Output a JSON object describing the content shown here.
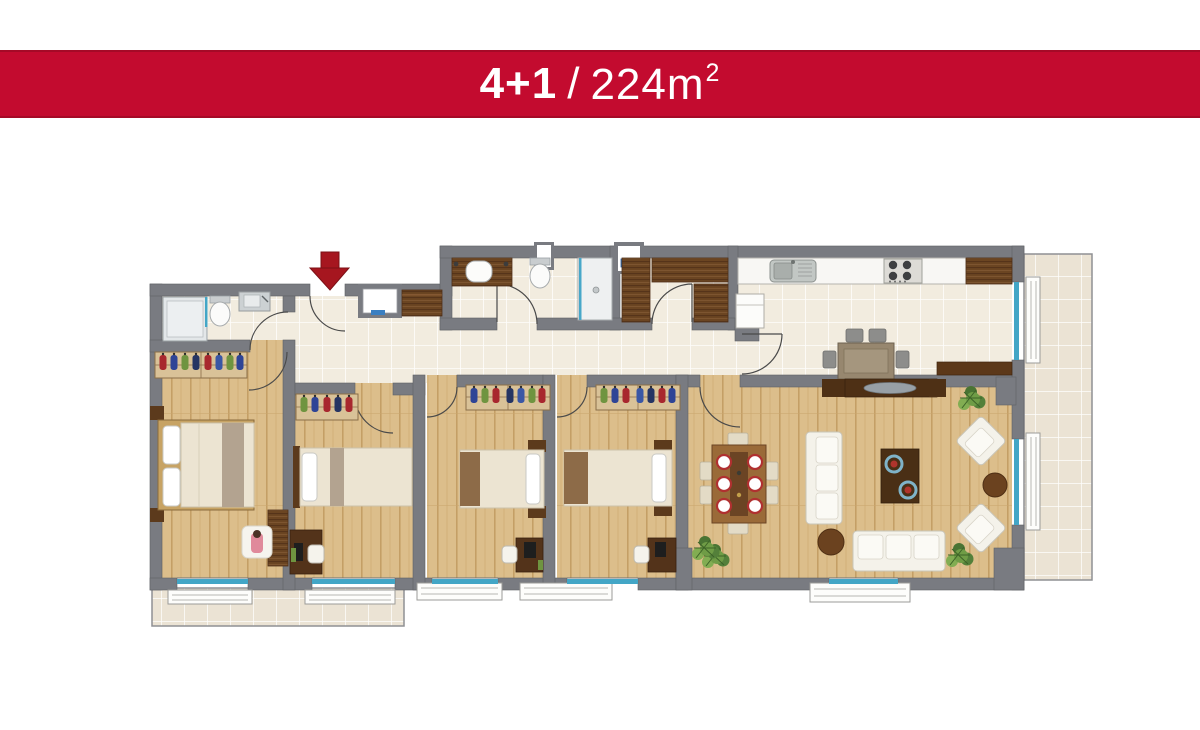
{
  "header": {
    "unit_type": "4+1",
    "separator": "/",
    "area": "224m",
    "area_sup": "2",
    "full_text": "4+1 / 224m2",
    "background": "#c30b2f",
    "text_color": "#ffffff"
  },
  "plan": {
    "entrance_marker": "red-arrow-down",
    "palette": {
      "wall": "#797b81",
      "wood_floor": "#dcbe8b",
      "tile_floor": "#f2ecdf",
      "balcony_tile": "#ebe3d4",
      "dark_wood": "#6b4522",
      "window_glass": "#43a6c6",
      "accent_red": "#a6161f",
      "furniture_white": "#f5f3ec"
    },
    "rooms": [
      "entrance-hall",
      "bathroom-1",
      "bathroom-2",
      "dressing-room",
      "kitchen",
      "master-bedroom",
      "bedroom-2",
      "bedroom-3",
      "bedroom-4",
      "living-room",
      "bottom-balcony",
      "right-balcony"
    ]
  }
}
